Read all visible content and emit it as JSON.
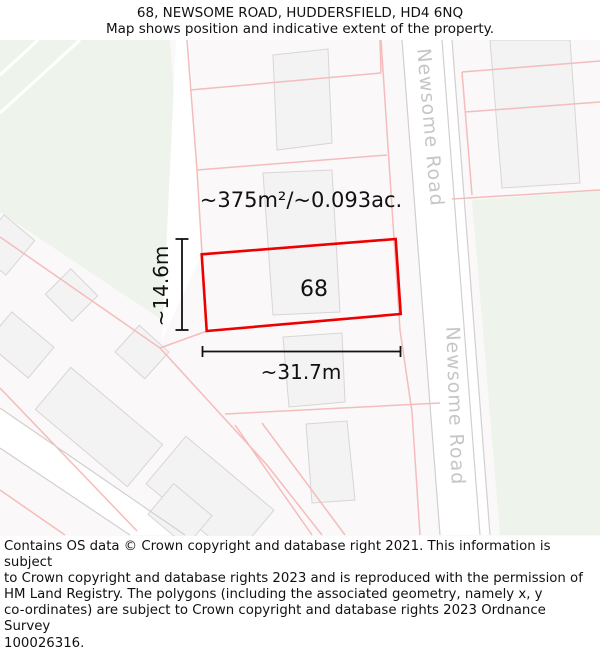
{
  "header": {
    "title": "68, NEWSOME ROAD, HUDDERSFIELD, HD4 6NQ",
    "subtitle": "Map shows position and indicative extent of the property."
  },
  "map": {
    "plot_number": "68",
    "area_label": "~375m²/~0.093ac.",
    "width_label": "~31.7m",
    "height_label": "~14.6m",
    "road_label": "Newsome Road",
    "colors": {
      "property_outline": "#ee0000",
      "parcel_line": "#f5bcbc",
      "road_edge": "#d2cfcf",
      "building_fill": "#f4f3f3",
      "building_edge": "#d8d5d5",
      "green_space": "#eef4eb",
      "map_background": "#faf8f8",
      "road_fill": "#ffffff",
      "annotation": "#111111",
      "road_label_text": "#c8c5c5"
    }
  },
  "footer": {
    "text": "Contains OS data © Crown copyright and database right 2021. This information is subject\nto Crown copyright and database rights 2023 and is reproduced with the permission of\nHM Land Registry. The polygons (including the associated geometry, namely x, y\nco-ordinates) are subject to Crown copyright and database rights 2023 Ordnance Survey\n100026316."
  }
}
